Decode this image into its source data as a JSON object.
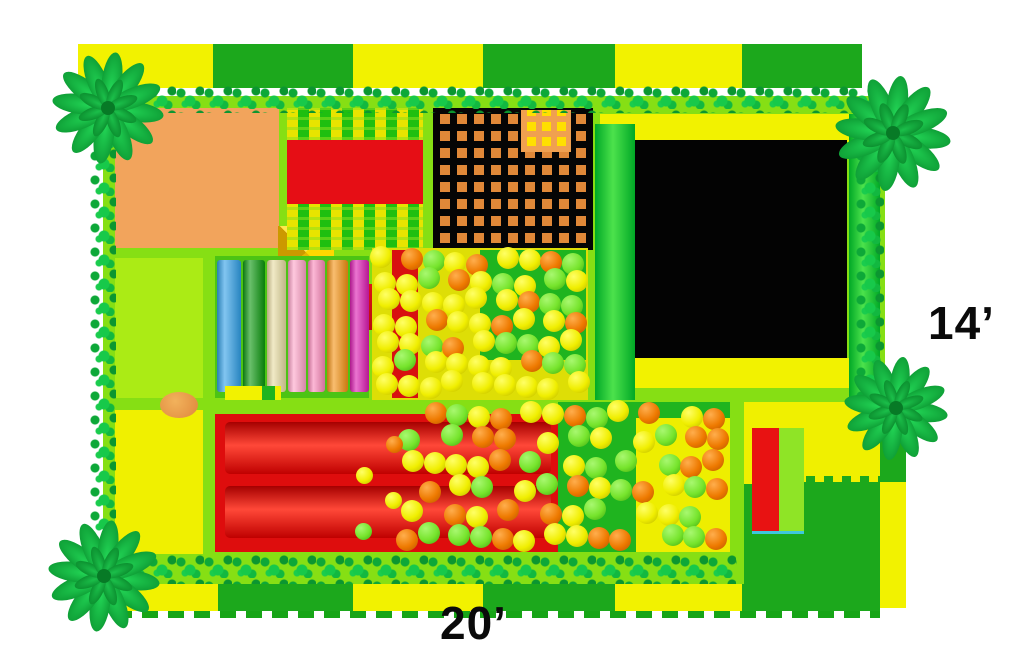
{
  "scene": {
    "type": "indoor-playground-floorplan-top-view"
  },
  "labels": {
    "width": "20’",
    "depth": "14’"
  },
  "palette": {
    "base_lime": "#86df14",
    "panel_lime": "#abeb15",
    "panel_yellow": "#f0f000",
    "orange_mat": "#f2a45c",
    "net_orange": "#e08838",
    "net_patch_yellow": "#ffdf00",
    "trampoline_black": "#030303",
    "frame_yellow": "#f2f200",
    "slide_red": "#de0d0d",
    "bridge_red": "#e60e15",
    "pit_floor_green": "#1fb41f",
    "pit_floor_yellow": "#eeee00",
    "tile_yellow": "#f2f200",
    "tile_green": "#1ca81c",
    "mini_slide_red": "#e81212",
    "mini_slide_green": "#8fe426",
    "garland_green": "#12b23c"
  },
  "border": {
    "top_tiles": [
      "yellow",
      "green",
      "yellow",
      "green",
      "yellow",
      "green"
    ],
    "bottom_tiles": [
      "yellow",
      "green",
      "yellow",
      "green",
      "yellow",
      "green"
    ]
  },
  "rollers": {
    "items": [
      {
        "name": "roller-blue",
        "color": "#35a2e8"
      },
      {
        "name": "roller-green",
        "color": "#0f9912"
      },
      {
        "name": "roller-beige",
        "color": "#e8dca4"
      },
      {
        "name": "roller-light-pink",
        "color": "#ffa6ca"
      },
      {
        "name": "roller-pink",
        "color": "#fb8cbc"
      },
      {
        "name": "roller-orange",
        "color": "#f59518"
      },
      {
        "name": "roller-magenta",
        "color": "#de1fb4"
      }
    ]
  },
  "balls": {
    "colors": {
      "yellow": {
        "c": "#f0ee00",
        "hl": "#ffff66",
        "sh": "#b8b400"
      },
      "green": {
        "c": "#76e42c",
        "hl": "#a8f870",
        "sh": "#3fa810"
      },
      "orange": {
        "c": "#ee7a00",
        "hl": "#ffae4d",
        "sh": "#b85400"
      }
    },
    "pattern": [
      "yellow",
      "green",
      "yellow",
      "orange",
      "green",
      "yellow",
      "green",
      "yellow",
      "orange",
      "yellow",
      "yellow",
      "green",
      "orange",
      "yellow",
      "green",
      "yellow",
      "orange",
      "green"
    ]
  }
}
